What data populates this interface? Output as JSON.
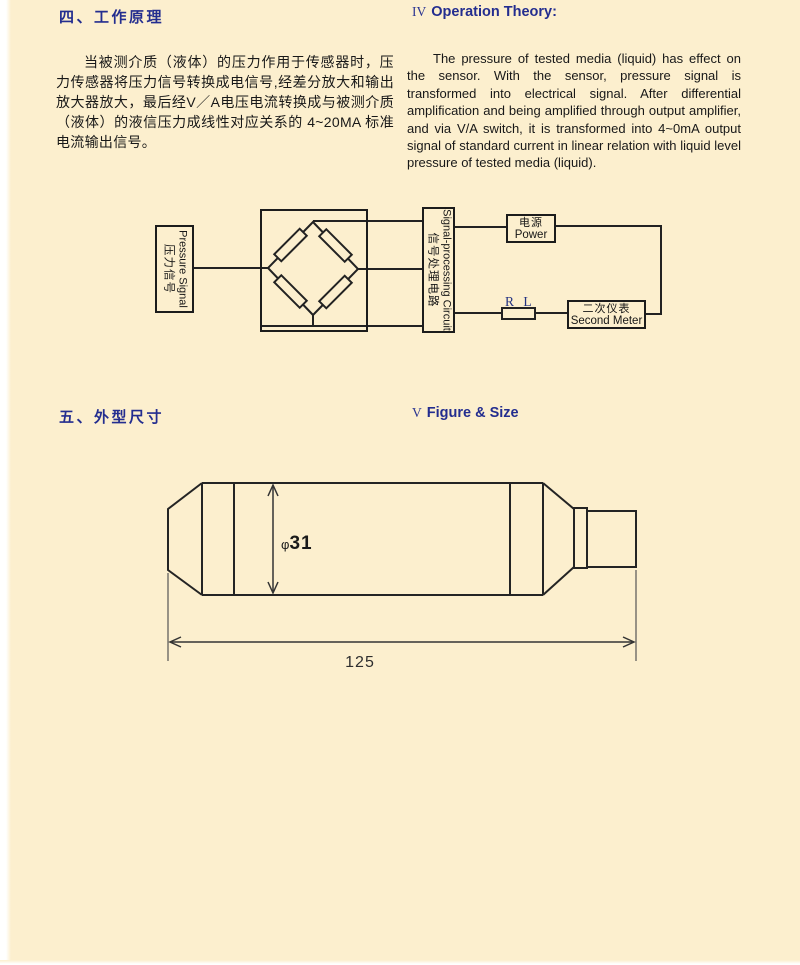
{
  "colors": {
    "background": "#fcefce",
    "heading_accent": "#232d8f",
    "body_text": "#181818",
    "line_color": "#222222"
  },
  "sections": {
    "theory": {
      "heading_zh": "四、工作原理",
      "heading_en_numeral": "IV",
      "heading_en": "Operation Theory:",
      "body_zh": "当被测介质（液体）的压力作用于传感器时，压力传感器将压力信号转换成电信号,经差分放大和输出放大器放大，最后经V／A电压电流转换成与被测介质（液体）的液信压力成线性对应关系的 4~20MA 标准电流输出信号。",
      "body_en": "The pressure of tested media (liquid) has effect on the sensor. With the sensor, pressure signal is transformed into electrical signal. After differential amplification and being amplified through output amplifier, and via V/A switch, it is transformed into 4~0mA output signal of standard current in linear relation with liquid level pressure of tested media (liquid)."
    },
    "size": {
      "heading_zh": "五、外型尺寸",
      "heading_en_numeral": "V",
      "heading_en": "Figure & Size"
    }
  },
  "diagram": {
    "pressure_box": {
      "en": "Pressure Signal",
      "zh": "压力信号"
    },
    "signal_box": {
      "en": "Signal-processing Circuit",
      "zh": "信号处理电路"
    },
    "power_box": {
      "zh": "电源",
      "en": "Power"
    },
    "load_resistor_label": "R L",
    "second_meter_box": {
      "zh": "二次仪表",
      "en": "Second Meter"
    }
  },
  "drawing": {
    "diameter_symbol": "φ",
    "diameter_value": "31",
    "length_value": "125"
  }
}
